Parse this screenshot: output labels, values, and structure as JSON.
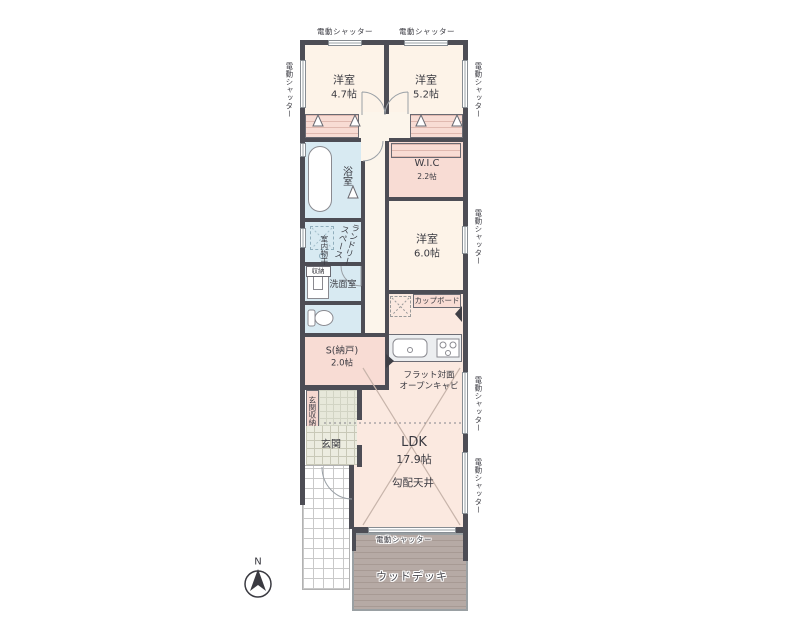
{
  "labels": {
    "shutter": "電動シャッター",
    "north": "N"
  },
  "rooms": {
    "bedroom1": {
      "name": "洋室",
      "size": "4.7帖"
    },
    "bedroom2": {
      "name": "洋室",
      "size": "5.2帖"
    },
    "wic": {
      "name": "W.I.C",
      "size": "2.2帖"
    },
    "bedroom3": {
      "name": "洋室",
      "size": "6.0帖"
    },
    "bathroom": {
      "name": "浴室"
    },
    "laundry": {
      "line1": "ランドリー",
      "line2": "スペース"
    },
    "indoor_drying": {
      "name": "室内物干"
    },
    "washroom": {
      "name": "洗面室"
    },
    "closet_small": {
      "name": "収納"
    },
    "storage": {
      "name": "S(納戸)",
      "size": "2.0帖"
    },
    "entrance_storage": {
      "name": "玄関収納"
    },
    "entrance": {
      "name": "玄関"
    },
    "ldk": {
      "name": "LDK",
      "size": "17.9帖"
    },
    "sloped_ceiling": {
      "name": "勾配天井"
    },
    "cupboard": {
      "name": "カップボード"
    },
    "kitchen_counter_note": {
      "line1": "フラット対面",
      "line2": "オープンキャビ"
    },
    "wood_deck": {
      "name": "ウッドデッキ"
    }
  }
}
